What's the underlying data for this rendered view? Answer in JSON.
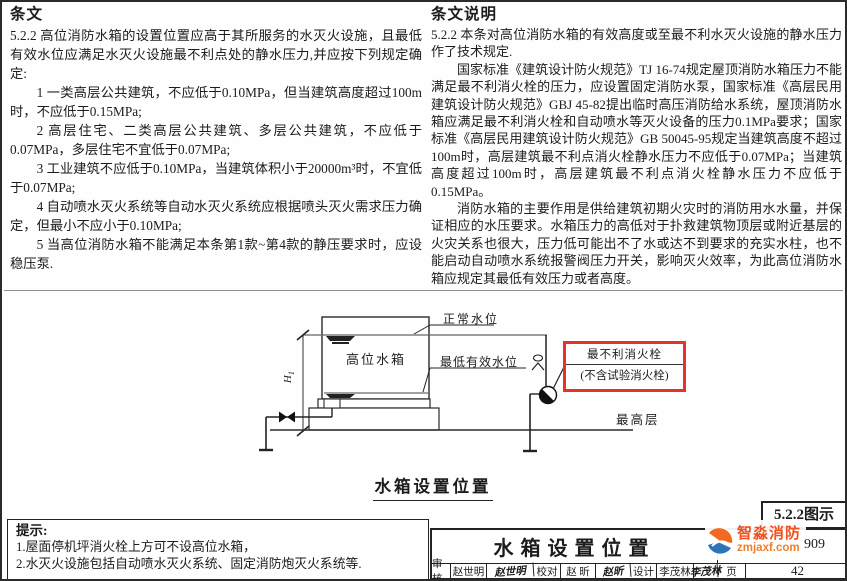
{
  "provisions": {
    "header": "条文",
    "intro": "5.2.2 高位消防水箱的设置位置应高于其所服务的水灭火设施，且最低有效水位应满足水灭火设施最不利点处的静水压力,并应按下列规定确定:",
    "items": [
      "1 一类高层公共建筑，不应低于0.10MPa，但当建筑高度超过100m时，不应低于0.15MPa;",
      "2 高层住宅、二类高层公共建筑、多层公共建筑，不应低于0.07MPa，多层住宅不宜低于0.07MPa;",
      "3 工业建筑不应低于0.10MPa，当建筑体积小于20000m³时，不宜低于0.07MPa;",
      "4 自动喷水灭火系统等自动水灭火系统应根据喷头灭火需求压力确定，但最小不应小于0.10MPa;",
      "5 当高位消防水箱不能满足本条第1款~第4款的静压要求时，应设稳压泵."
    ]
  },
  "explanation": {
    "header": "条文说明",
    "paragraphs": [
      "5.2.2 本条对高位消防水箱的有效高度或至最不利水灭火设施的静水压力作了技术规定.",
      "国家标准《建筑设计防火规范》TJ 16-74规定屋顶消防水箱压力不能满足最不利消火栓的压力，应设置固定消防水泵，国家标准《高层民用建筑设计防火规范》GBJ 45-82提出临时高压消防给水系统，屋顶消防水箱应满足最不利消火栓和自动喷水等灭火设备的压力0.1MPa要求；国家标准《高层民用建筑设计防火规范》GB 50045-95规定当建筑高度不超过100m时，高层建筑最不利点消火栓静水压力不应低于0.07MPa；当建筑高度超过100m时，高层建筑最不利点消火栓静水压力不应低于0.15MPa。",
      "消防水箱的主要作用是供给建筑初期火灾时的消防用水水量，并保证相应的水压要求。水箱压力的高低对于扑救建筑物顶层或附近基层的火灾关系也很大，压力低可能出不了水或达不到要求的充实水柱，也不能启动自动喷水系统报警阀压力开关，影响灭火效率，为此高位消防水箱应规定其最低有效压力或者高度。"
    ]
  },
  "figure": {
    "tank_label": "高位水箱",
    "normal_level": "正常水位",
    "lowest_level": "最低有效水位",
    "dim_base": "H",
    "dim_sub": "1",
    "hydrant_line1": "最不利消火栓",
    "hydrant_line2": "(不含试验消火栓)",
    "top_floor": "最高层",
    "caption": "水箱设置位置",
    "highlight_color": "#e5332a"
  },
  "notes": {
    "header": "提示:",
    "items": [
      "1.屋面停机坪消火栓上方可不设高位水箱，",
      "2.水灭火设施包括自动喷水灭火系统、固定消防炮灭火系统等."
    ]
  },
  "titleblock": {
    "figure_no": "5.2.2图示",
    "title": "水箱设置位置",
    "atlas_no_visible": "909",
    "reviewer_label": "审核",
    "reviewer_name": "赵世明",
    "reviewer_sig": "赵世明",
    "proofreader_label": "校对",
    "proofreader_name": "赵 昕",
    "proofreader_sig": "赵昕",
    "designer_label": "设计",
    "designer_name": "李茂林",
    "designer_sig": "李茂林",
    "page_label": "页",
    "page_no": "42"
  },
  "watermark": {
    "name": "智淼消防",
    "site": "zmjaxf.com"
  }
}
